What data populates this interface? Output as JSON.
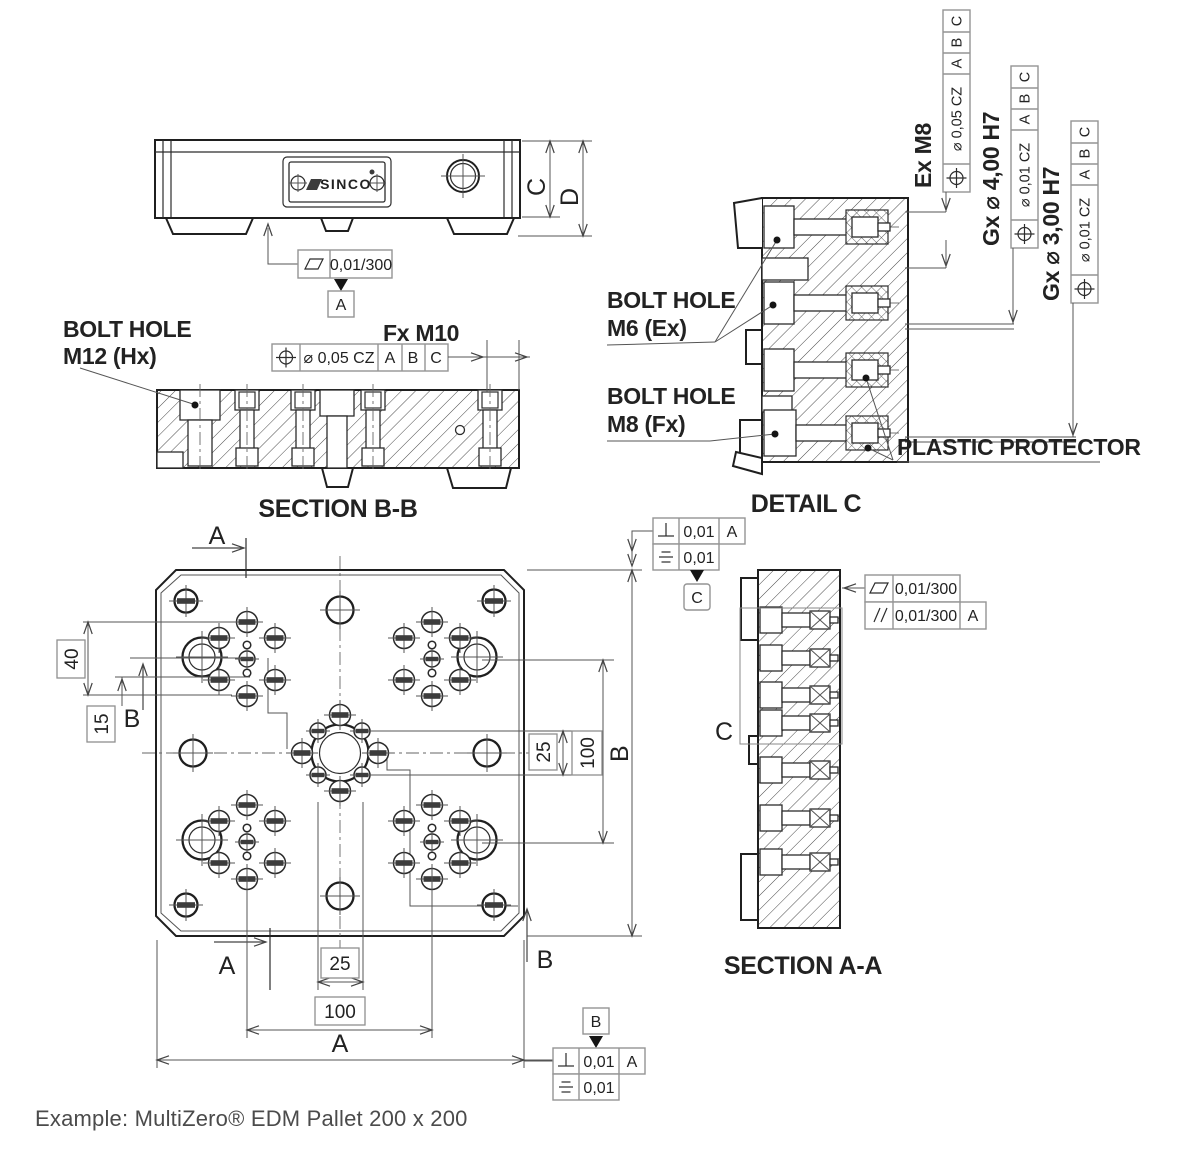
{
  "logo": "SINCO",
  "example_caption": "Example: MultiZero® EDM Pallet 200 x 200",
  "captions": {
    "section_bb": "SECTION B-B",
    "detail_c": "DETAIL C",
    "section_aa": "SECTION A-A"
  },
  "labels": {
    "bolt_hole_m12": [
      "BOLT HOLE",
      "M12 (Hx)"
    ],
    "fx_m10": "Fx M10",
    "bolt_hole_m6": [
      "BOLT HOLE",
      "M6 (Ex)"
    ],
    "bolt_hole_m8": [
      "BOLT HOLE",
      "M8 (Fx)"
    ],
    "plastic_protector": "PLASTIC PROTECTOR",
    "ex_m8": "Ex M8",
    "gx_d4": "Gx ⌀ 4,00 H7",
    "gx_d3": "Gx ⌀ 3,00 H7",
    "zone_c": "C"
  },
  "datums": {
    "a": "A",
    "b": "B",
    "c": "C"
  },
  "sections": {
    "a_top": "A",
    "a_bottom": "A",
    "b_left": "B",
    "b_right": "B"
  },
  "dims": {
    "left_40": "40",
    "left_15": "15",
    "right_25": "25",
    "right_100": "100",
    "bottom_25": "25",
    "bottom_100": "100",
    "overall_a": "A",
    "overall_b": "B",
    "thick_c": "C",
    "thick_d": "D"
  },
  "fcf": {
    "flatness_a": {
      "tol": "0,01/300",
      "datum": "A"
    },
    "pos_fx_m10": {
      "tol": "⌀ 0,05 CZ",
      "d1": "A",
      "d2": "B",
      "d3": "C"
    },
    "pos_ex_m8": {
      "tol": "⌀ 0,05 CZ",
      "d1": "A",
      "d2": "B",
      "d3": "C"
    },
    "pos_gx_d4": {
      "tol": "⌀ 0,01 CZ",
      "d1": "A",
      "d2": "B",
      "d3": "C"
    },
    "pos_gx_d3": {
      "tol": "⌀ 0,01 CZ",
      "d1": "A",
      "d2": "B",
      "d3": "C"
    },
    "plan_top": {
      "perp_tol": "0,01",
      "perp_datum": "A",
      "sym_tol": "0,01"
    },
    "plan_bottom": {
      "perp_tol": "0,01",
      "perp_datum": "A",
      "sym_tol": "0,01"
    },
    "section_aa": {
      "flat_tol": "0,01/300",
      "par_tol": "0,01/300",
      "par_datum": "A"
    }
  },
  "icons": {
    "position": "circle-crosshair",
    "flatness": "parallelogram",
    "perpendicularity": "inverted-tee",
    "symmetry": "three-horizontal-lines",
    "parallelism": "double-slash",
    "diameter": "slashed-circle",
    "datum_triangle": "filled-triangle",
    "screw_cross": "circle-plus"
  },
  "colors": {
    "line": "#1f1f1f",
    "frame_border": "#949494",
    "text": "#222222",
    "example_text": "#4b4b4b",
    "slot_fill": "#3c3c3c"
  }
}
